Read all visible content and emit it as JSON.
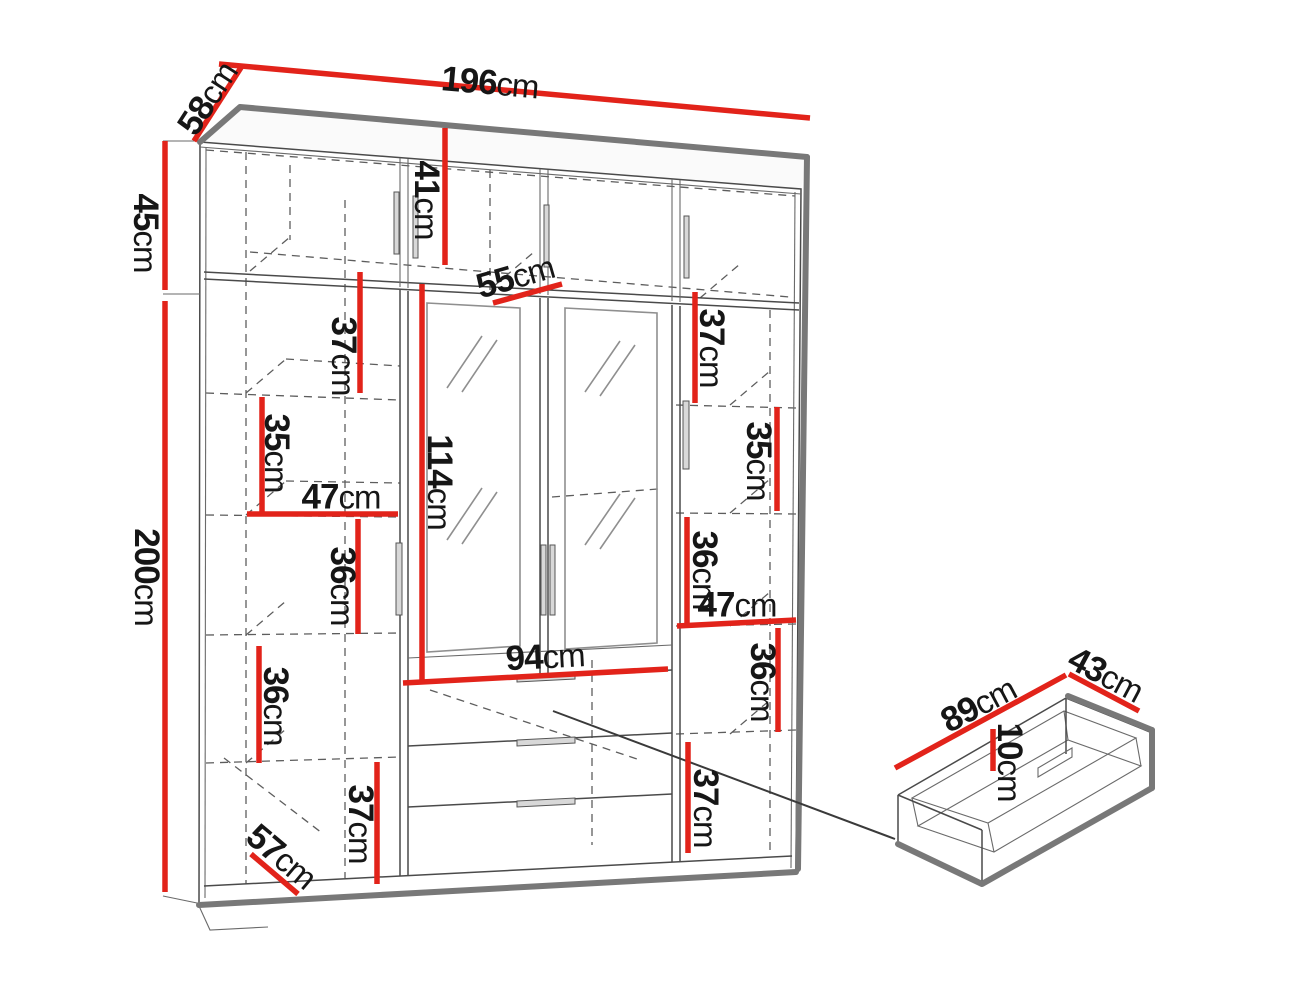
{
  "figure": {
    "type": "furniture-dimension-diagram",
    "subject": "wardrobe with mirrored doors, top cabinet and drawers",
    "detail_view": "pull-out drawer"
  },
  "colors": {
    "dimension_line": "#e2231a",
    "text": "#161616",
    "edge_thin": "#4a4a4a",
    "edge_thick": "#787878",
    "background": "#ffffff"
  },
  "dimensions": {
    "overall": {
      "width": "196cm",
      "depth": "58cm",
      "top_section_height": "45cm",
      "main_section_height": "200cm"
    },
    "top_section": {
      "interior_height": "41cm",
      "shelf_depth": "55cm"
    },
    "left_column": {
      "shelf_spacings": [
        "37cm",
        "35cm",
        "36cm",
        "36cm",
        "37cm"
      ],
      "shelf_width": "47cm",
      "bottom_depth": "57cm"
    },
    "right_column": {
      "shelf_spacings": [
        "37cm",
        "35cm",
        "36cm",
        "36cm",
        "37cm"
      ],
      "shelf_width": "47cm"
    },
    "center_section": {
      "mirror_door_height": "114cm",
      "drawer_section_width": "94cm"
    },
    "drawer": {
      "width": "89cm",
      "depth": "43cm",
      "height": "10cm"
    }
  },
  "labels": {
    "d58": "58cm",
    "d196": "196cm",
    "d45": "45cm",
    "d200": "200cm",
    "d41": "41cm",
    "d55": "55cm",
    "d37_left_top": "37cm",
    "d35_left": "35cm",
    "d47_left": "47cm",
    "d36_left_mid": "36cm",
    "d36_left_low": "36cm",
    "d57": "57cm",
    "d37_bottom": "37cm",
    "d94": "94cm",
    "d114": "114cm",
    "d37_right_top": "37cm",
    "d35_right": "35cm",
    "d36_right_up": "36cm",
    "d47_right": "47cm",
    "d36_right_low": "36cm",
    "d37_right_bottom": "37cm",
    "d89": "89cm",
    "d43": "43cm",
    "d10": "10cm"
  }
}
